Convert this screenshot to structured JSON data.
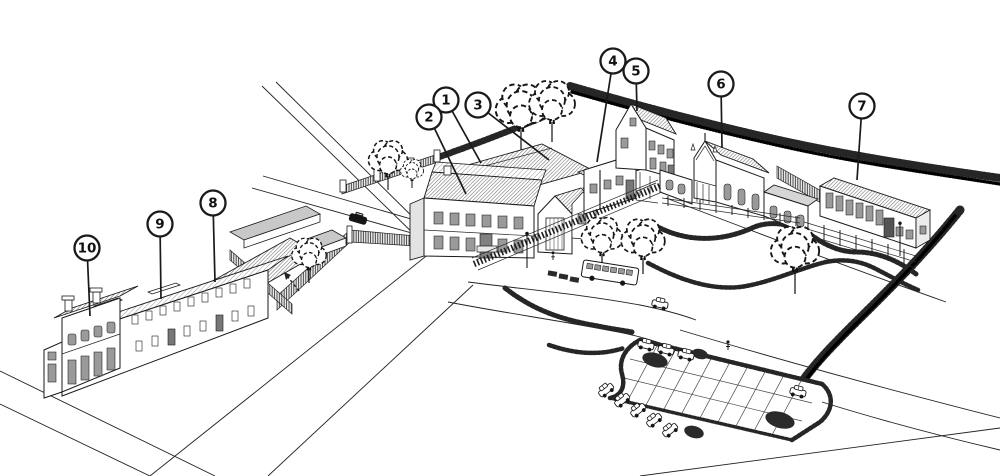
{
  "figure": {
    "kind": "isometric-site-plan-line-drawing",
    "description": "Bird's-eye pen drawing of a building ensemble with roads, fences, trees, parked vehicles, a parking lot and ten numbered key markers",
    "background": "#ffffff",
    "ink": "#1a1a1a",
    "marker_style": {
      "fill": "#ffffff",
      "stroke": "#1a1a1a",
      "radius": 12.5
    }
  },
  "markers": [
    {
      "label": "1",
      "cx": 446,
      "cy": 100,
      "lx": 481,
      "ly": 163
    },
    {
      "label": "2",
      "cx": 429,
      "cy": 117,
      "lx": 466,
      "ly": 194
    },
    {
      "label": "3",
      "cx": 478,
      "cy": 105,
      "lx": 549,
      "ly": 160
    },
    {
      "label": "4",
      "cx": 613,
      "cy": 61,
      "lx": 597,
      "ly": 162
    },
    {
      "label": "5",
      "cx": 636,
      "cy": 71,
      "lx": 637,
      "ly": 111
    },
    {
      "label": "6",
      "cx": 721,
      "cy": 84,
      "lx": 722,
      "ly": 148
    },
    {
      "label": "7",
      "cx": 862,
      "cy": 106,
      "lx": 857,
      "ly": 180
    },
    {
      "label": "8",
      "cx": 213,
      "cy": 203,
      "lx": 215,
      "ly": 282
    },
    {
      "label": "9",
      "cx": 160,
      "cy": 224,
      "lx": 161,
      "ly": 299
    },
    {
      "label": "10",
      "cx": 87,
      "cy": 248,
      "lx": 90,
      "ly": 316
    }
  ]
}
